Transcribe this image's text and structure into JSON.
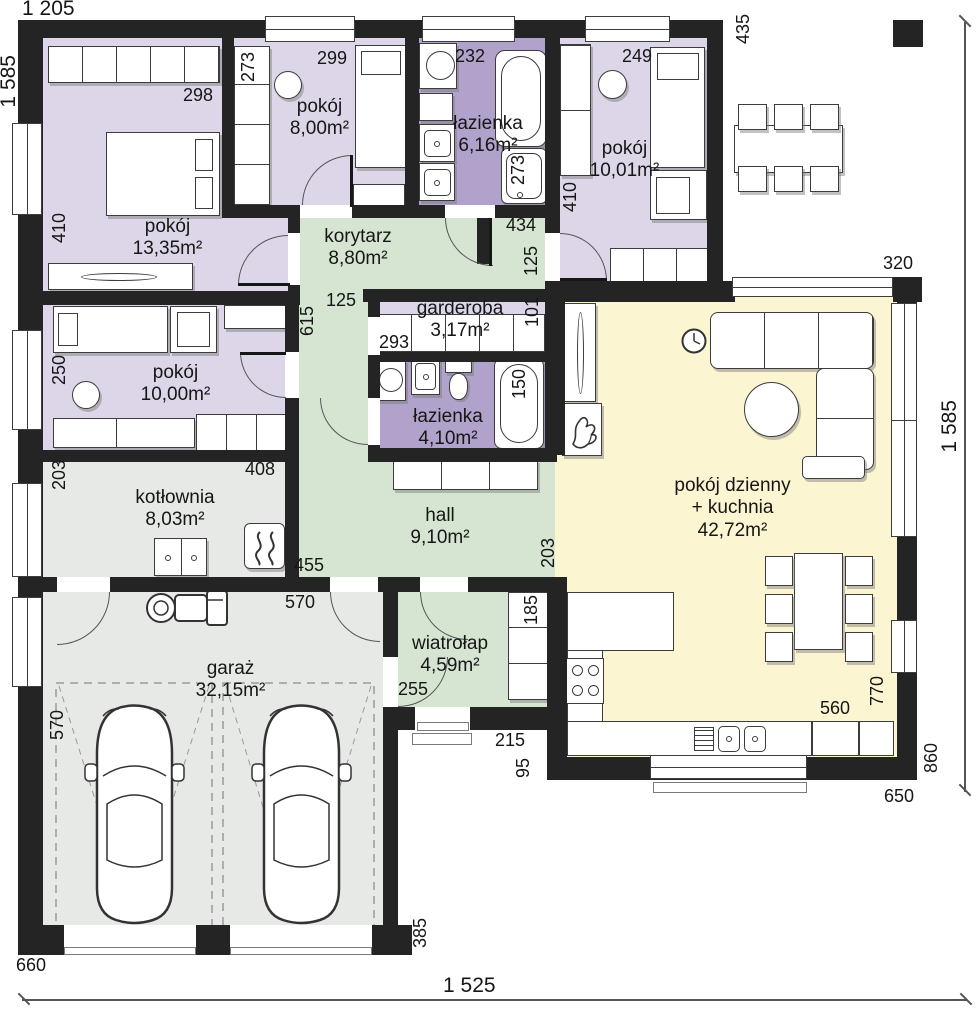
{
  "colors": {
    "wall": "#242424",
    "purpleLight": "#ddd6e8",
    "purpleDark": "#b0a2ca",
    "green": "#d6e5d2",
    "yellow": "#fbf5d2",
    "gray": "#e7e9e6"
  },
  "rooms": {
    "p1335": {
      "name": "pokój",
      "area": "13,35m²"
    },
    "p800": {
      "name": "pokój",
      "area": "8,00m²"
    },
    "laz616": {
      "name": "łazienka",
      "area": "6,16m²"
    },
    "p1001": {
      "name": "pokój",
      "area": "10,01m²"
    },
    "korytarz": {
      "name": "korytarz",
      "area": "8,80m²"
    },
    "garderoba": {
      "name": "garderoba",
      "area": "3,17m²"
    },
    "laz410": {
      "name": "łazienka",
      "area": "4,10m²"
    },
    "hall": {
      "name": "hall",
      "area": "9,10m²"
    },
    "p1000": {
      "name": "pokój",
      "area": "10,00m²"
    },
    "kotlownia": {
      "name": "kotłownia",
      "area": "8,03m²"
    },
    "dzienny": {
      "name": "pokój dzienny",
      "name2": "+ kuchnia",
      "area": "42,72m²"
    },
    "garaz": {
      "name": "garaż",
      "area": "32,15m²"
    },
    "wiatrolap": {
      "name": "wiatrołap",
      "area": "4,59m²"
    }
  },
  "dims": {
    "top_width": "1 205",
    "left_height": "1 585",
    "right_height": "1 585",
    "bottom_width": "1 525",
    "d435": "435",
    "d320": "320",
    "d298": "298",
    "d273_szafa": "273",
    "d299": "299",
    "d232": "232",
    "d273_prysznic": "273",
    "d249": "249",
    "d410_p1001": "410",
    "d410_p1335": "410",
    "d434": "434",
    "d125_korytarz": "125",
    "d125_strip": "125",
    "d615": "615",
    "d293": "293",
    "d101": "101",
    "d150": "150",
    "d250": "250",
    "d203_kotlownia": "203",
    "d408": "408",
    "d455": "455",
    "d203_hall": "203",
    "d570_garaz_top": "570",
    "d570_garaz_left": "570",
    "d185": "185",
    "d255": "255",
    "d215": "215",
    "d95": "95",
    "d560": "560",
    "d770": "770",
    "d860": "860",
    "d650": "650",
    "d660": "660",
    "d385": "385"
  }
}
